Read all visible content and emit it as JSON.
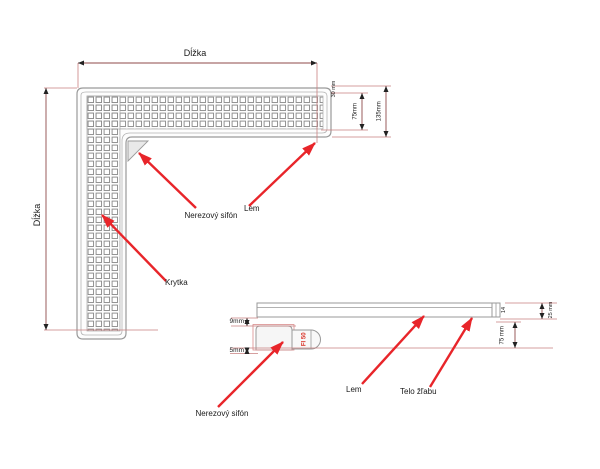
{
  "colors": {
    "drawing_gray": "#9a9a9a",
    "dim_line_red": "#8f4a4a",
    "extension_red": "#c97f7f",
    "callout_arrow_red": "#e8252a",
    "pipe_label_red": "#d93025",
    "text_black": "#1a1a1a"
  },
  "top_view": {
    "length_top": "Dĺžka",
    "length_left": "Dĺžka",
    "dim_rim": "30 mm",
    "dim_grid_width": "75mm",
    "dim_total_width": "135mm",
    "callouts": {
      "siphon": "Nerezový sifón",
      "rim": "Lem",
      "cover": "Krytka"
    }
  },
  "side_view": {
    "dim_top_gap": "9mm",
    "dim_bottom_gap": "5mm",
    "dim_edge": "14",
    "dim_height": "25 mm",
    "dim_depth": "75 mm",
    "pipe_diameter": "FI 50",
    "callouts": {
      "siphon": "Nerezový sifón",
      "rim": "Lem",
      "body": "Telo žľabu"
    }
  }
}
